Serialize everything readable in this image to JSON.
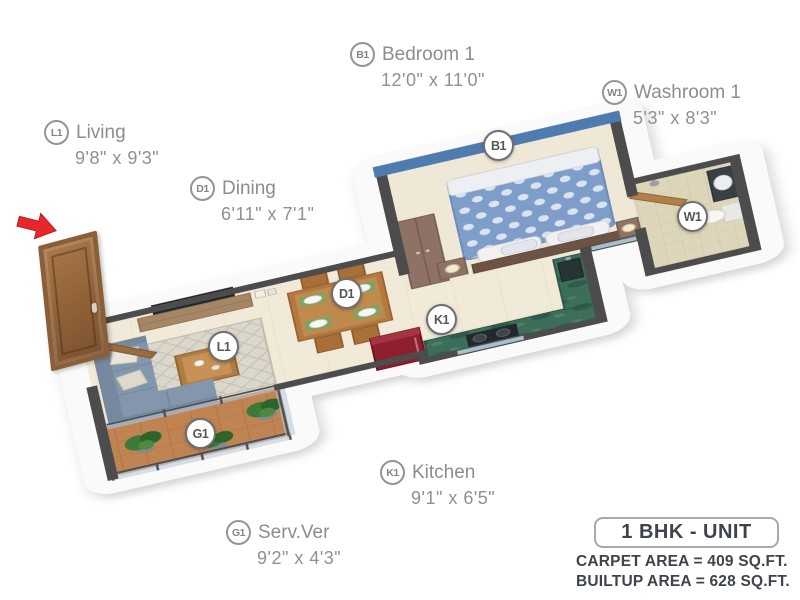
{
  "page": {
    "background": "#ffffff",
    "type": "isometric floor plan render"
  },
  "rooms": [
    {
      "code": "B1",
      "name": "Bedroom 1",
      "dims": "12'0\" x 11'0\""
    },
    {
      "code": "W1",
      "name": "Washroom 1",
      "dims": "5'3\" x 8'3\""
    },
    {
      "code": "L1",
      "name": "Living",
      "dims": "9'8\" x 9'3\""
    },
    {
      "code": "D1",
      "name": "Dining",
      "dims": "6'11\" x 7'1\""
    },
    {
      "code": "K1",
      "name": "Kitchen",
      "dims": "9'1\" x 6'5\""
    },
    {
      "code": "G1",
      "name": "Serv.Ver",
      "dims": "9'2\" x 4'3\""
    }
  ],
  "unit_info": {
    "title": "1 BHK - UNIT",
    "carpet_area": "CARPET AREA = 409 SQ.FT.",
    "builtup_area": "BUILTUP AREA = 628 SQ.FT."
  },
  "icons": {
    "entry_arrow": "red-entry-arrow pointing at entrance door"
  },
  "colors": {
    "accent_wall_blue": "#4e7cb0",
    "entry_arrow_red": "#e8262b",
    "fridge_red": "#8e1f2f",
    "kitchen_granite_green": "#3c6e5a",
    "balcony_terracotta": "#c08352",
    "sofa_grey_blue": "#8496ab",
    "wood_brown": "#b5793f",
    "wall_dark_grey": "#4c4c4c",
    "label_grey": "#8d8d8d",
    "info_text_dark": "#3f434d"
  }
}
